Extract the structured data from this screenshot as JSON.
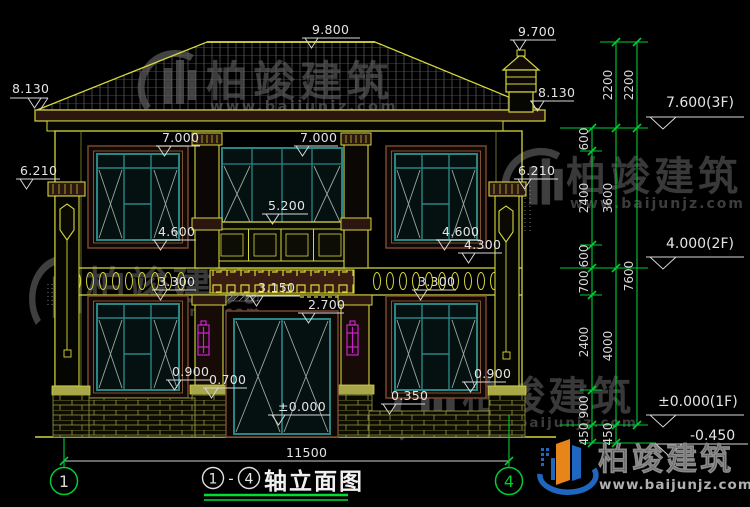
{
  "facade": {
    "ridge": "9.800",
    "chimney": "9.700",
    "eave_left": "8.130",
    "eave_right": "8.130",
    "win_head_left": "7.000",
    "win_head_right": "7.000",
    "pillar_left": "6.210",
    "pillar_right": "6.210",
    "balcony_rail": "5.200",
    "sill2_left": "4.600",
    "sill2_right": "4.600",
    "lamp_right": "4.300",
    "band_left": "3.300",
    "band_right": "3.300",
    "balcony_bottom": "3.150",
    "door_head": "2.700",
    "sill1_left": "0.900",
    "sill1_right": "0.900",
    "plinth_center": "0.700",
    "plinth_right": "0.350",
    "ground": "±0.000",
    "total_width": "11500"
  },
  "levels": {
    "f3": "7.600(3F)",
    "f2": "4.000(2F)",
    "f1": "±0.000(1F)",
    "below": "-0.450"
  },
  "chains": {
    "inner": [
      "600",
      "2400",
      "600",
      "700",
      "2400",
      "900",
      "450"
    ],
    "mid": [
      "2200",
      "3600",
      "4000",
      "450"
    ],
    "outer": [
      "2200",
      "7600"
    ]
  },
  "axes": {
    "left": "1",
    "right": "4"
  },
  "titleblock": {
    "axis_start": "1",
    "separator": "-",
    "axis_end": "4",
    "title": "轴立面图"
  },
  "watermark": {
    "brand": "柏竣建筑",
    "url": "www.baijunjz.com"
  },
  "colors": {
    "background": "#000000",
    "line_yellow": "#d6d63c",
    "line_green": "#00cc33",
    "frame_teal": "#2a8585",
    "surround_brown": "#7a4630",
    "accent_magenta": "#cc22cc",
    "text_white": "#e4e4e4",
    "brand_blue": "#1f66c0",
    "brand_orange": "#e8851a"
  }
}
